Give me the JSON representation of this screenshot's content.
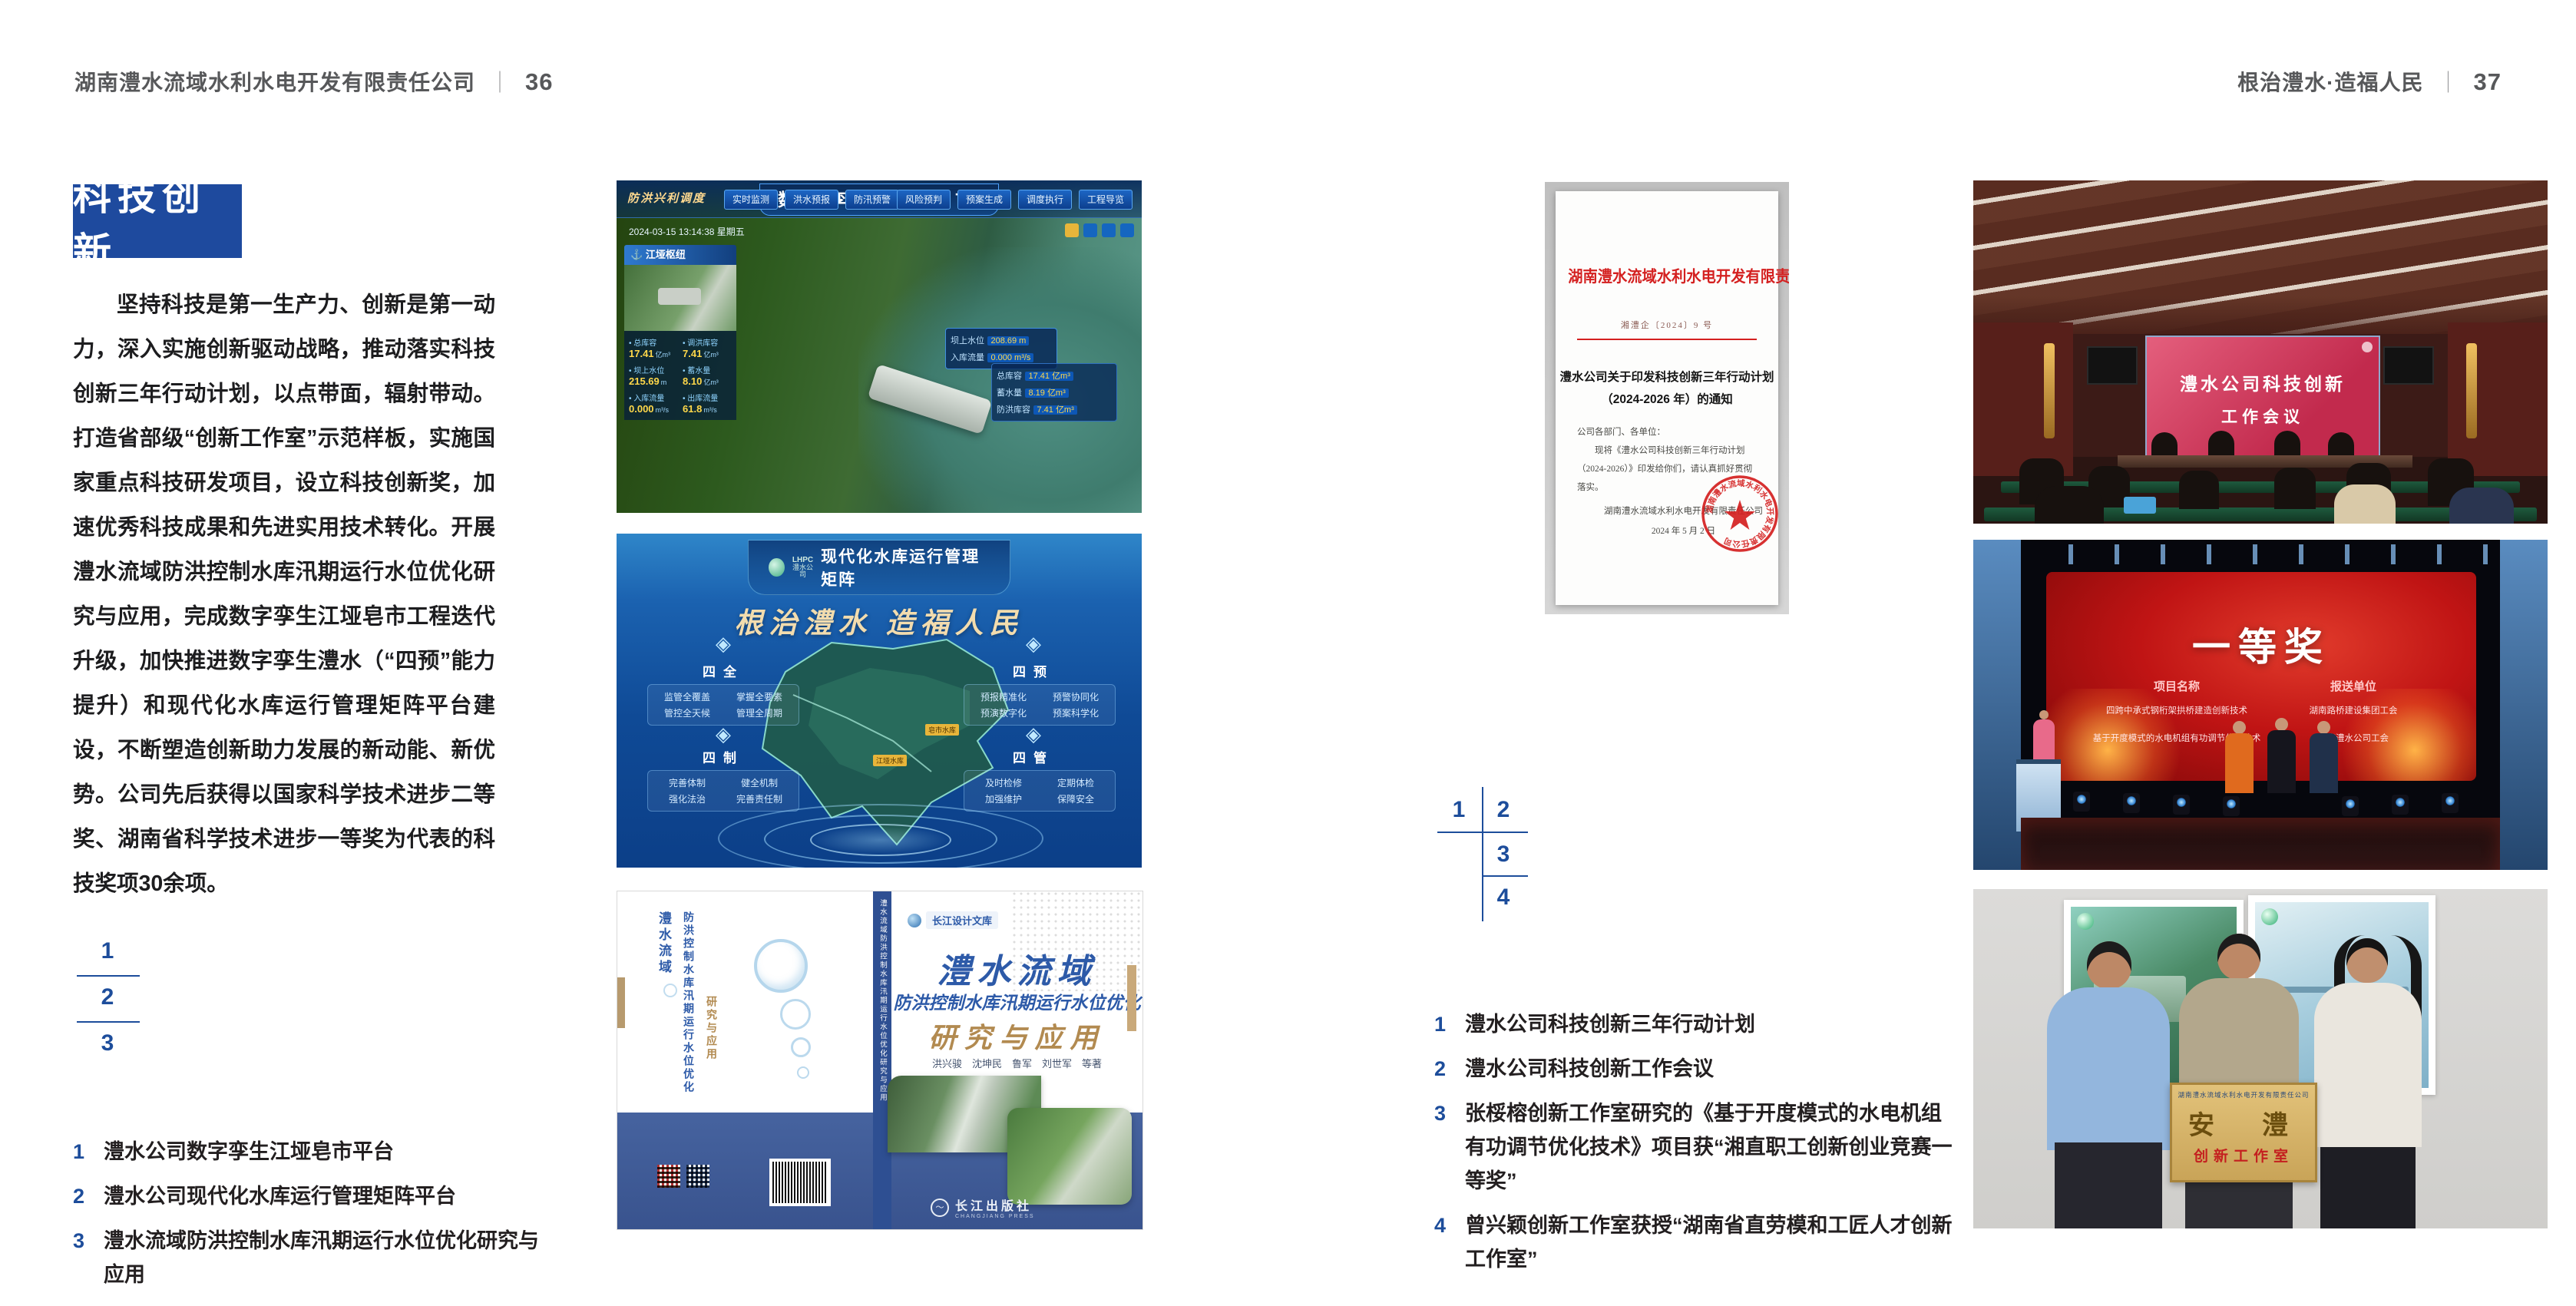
{
  "colors": {
    "accent_blue": "#1e4a9e",
    "doc_red": "#d42020",
    "gold": "#f0d9a8"
  },
  "header_left": {
    "company": "湖南澧水流域水利水电开发有限责任公司",
    "sep": "｜",
    "page": "36"
  },
  "header_right": {
    "slogan": "根治澧水·造福人民",
    "sep": "｜",
    "page": "37"
  },
  "left_page": {
    "badge": "科技创新",
    "paragraph": "坚持科技是第一生产力、创新是第一动力，深入实施创新驱动战略，推动落实科技创新三年行动计划，以点带面，辐射带动。打造省部级“创新工作室”示范样板，实施国家重点科技研发项目，设立科技创新奖，加速优秀科技成果和先进实用技术转化。开展澧水流域防洪控制水库汛期运行水位优化研究与应用，完成数字孪生江垭皂市工程迭代升级，加快推进数字孪生澧水（“四预”能力提升）和现代化水库运行管理矩阵平台建设，不断塑造创新助力发展的新动能、新优势。公司先后获得以国家科学技术进步二等奖、湖南省科学技术进步一等奖为代表的科技奖项30余项。",
    "index": [
      "1",
      "2",
      "3"
    ],
    "captions": [
      {
        "num": "1",
        "text": "澧水公司数字孪生江垭皂市平台"
      },
      {
        "num": "2",
        "text": "澧水公司现代化水库运行管理矩阵平台"
      },
      {
        "num": "3",
        "text": "澧水流域防洪控制水库汛期运行水位优化研究与应用"
      }
    ]
  },
  "right_page": {
    "index": [
      "1",
      "2",
      "3",
      "4"
    ],
    "captions": [
      {
        "num": "1",
        "text": "澧水公司科技创新三年行动计划"
      },
      {
        "num": "2",
        "text": "澧水公司科技创新工作会议"
      },
      {
        "num": "3",
        "text": "张桵榕创新工作室研究的《基于开度模式的水电机组有功调节优化技术》项目获“湘直职工创新创业竞赛一等奖”"
      },
      {
        "num": "4",
        "text": "曾兴颖创新工作室获授“湖南省直劳模和工匠人才创新工作室”"
      }
    ]
  },
  "fig_dashboard": {
    "title": "数字孪生江垭皂市",
    "mode_label": "防洪兴利调度",
    "tabs_left": [
      "实时监测",
      "洪水预报",
      "防汛预警"
    ],
    "tabs_right": [
      "风险预判",
      "预案生成",
      "调度执行",
      "工程导览"
    ],
    "timestamp": "2024-03-15 13:14:38 星期五",
    "panel_title": "江垭枢纽",
    "stats": [
      {
        "label": "总库容",
        "value": "17.41",
        "unit": "亿m³"
      },
      {
        "label": "调洪库容",
        "value": "7.41",
        "unit": "亿m³"
      },
      {
        "label": "坝上水位",
        "value": "215.69",
        "unit": "m"
      },
      {
        "label": "蓄水量",
        "value": "8.10",
        "unit": "亿m³"
      },
      {
        "label": "入库流量",
        "value": "0.000",
        "unit": "m³/s"
      },
      {
        "label": "出库流量",
        "value": "61.8",
        "unit": "m³/s"
      }
    ],
    "tooltip": [
      {
        "label": "坝上水位",
        "value": "208.69",
        "unit": "m"
      },
      {
        "label": "入库流量",
        "value": "0.000",
        "unit": "m³/s"
      }
    ],
    "side_panel": [
      {
        "label": "总库容",
        "value": "17.41",
        "unit": "亿m³"
      },
      {
        "label": "蓄水量",
        "value": "8.19",
        "unit": "亿m³"
      },
      {
        "label": "防洪库容",
        "value": "7.41",
        "unit": "亿m³"
      }
    ]
  },
  "fig_matrix": {
    "logo_text": "LHPC",
    "logo_sub": "澧水公司",
    "title": "现代化水库运行管理矩阵",
    "slogan": "根治澧水 造福人民",
    "quadrants": [
      {
        "title": "四全",
        "items": [
          "监管全覆盖",
          "掌握全要素",
          "管控全天候",
          "管理全周期"
        ]
      },
      {
        "title": "四预",
        "items": [
          "预报精准化",
          "预警协同化",
          "预演数字化",
          "预案科学化"
        ]
      },
      {
        "title": "四制",
        "items": [
          "完善体制",
          "健全机制",
          "强化法治",
          "完善责任制"
        ]
      },
      {
        "title": "四管",
        "items": [
          "及时检修",
          "定期体检",
          "加强维护",
          "保障安全"
        ]
      }
    ],
    "map_labels": [
      "江垭水库",
      "皂市水库"
    ]
  },
  "fig_book": {
    "series": "长江设计文库",
    "title": "澧水流域",
    "subtitle": "防洪控制水库汛期运行水位优化",
    "subtitle2": "研究与应用",
    "authors": "洪兴骏　沈坤民　鲁军　刘世军　等著",
    "publisher": "长江出版社",
    "publisher_en": "CHANGJIANG PRESS",
    "spine_text": "澧水流域防洪控制水库汛期运行水位优化研究与应用",
    "back_title_1": "澧水流域",
    "back_title_2": "防洪控制水库汛期运行水位优化",
    "back_title_3": "研究与应用"
  },
  "fig_document": {
    "header": "湖南澧水流域水利水电开发有限责任公司文件",
    "doc_no": "湘澧企〔2024〕9 号",
    "title_line1": "澧水公司关于印发科技创新三年行动计划",
    "title_line2": "（2024-2026 年）的通知",
    "salutation": "公司各部门、各单位：",
    "body": "现将《澧水公司科技创新三年行动计划（2024-2026）》印发给你们，请认真抓好贯彻落实。",
    "signer": "湖南澧水流域水利水电开发有限责任公司",
    "date": "2024 年 5 月 2 日",
    "seal_text": "湖南澧水流域水利水电开发有限责任公司"
  },
  "fig_meeting": {
    "screen_line1": "澧水公司科技创新",
    "screen_line2": "工作会议"
  },
  "fig_award": {
    "title": "一等奖",
    "col1_header": "项目名称",
    "col2_header": "报送单位",
    "projects": [
      "四跨中承式钢桁架拱桥建造创新技术",
      "基于开度模式的水电机组有功调节优化技术"
    ],
    "units": [
      "湖南路桥建设集团工会",
      "湖南澧水公司工会"
    ]
  },
  "fig_team": {
    "plaque_header": "湖南澧水流域水利水电开发有限责任公司",
    "plaque_title": "安　澧",
    "plaque_sub": "创新工作室"
  }
}
